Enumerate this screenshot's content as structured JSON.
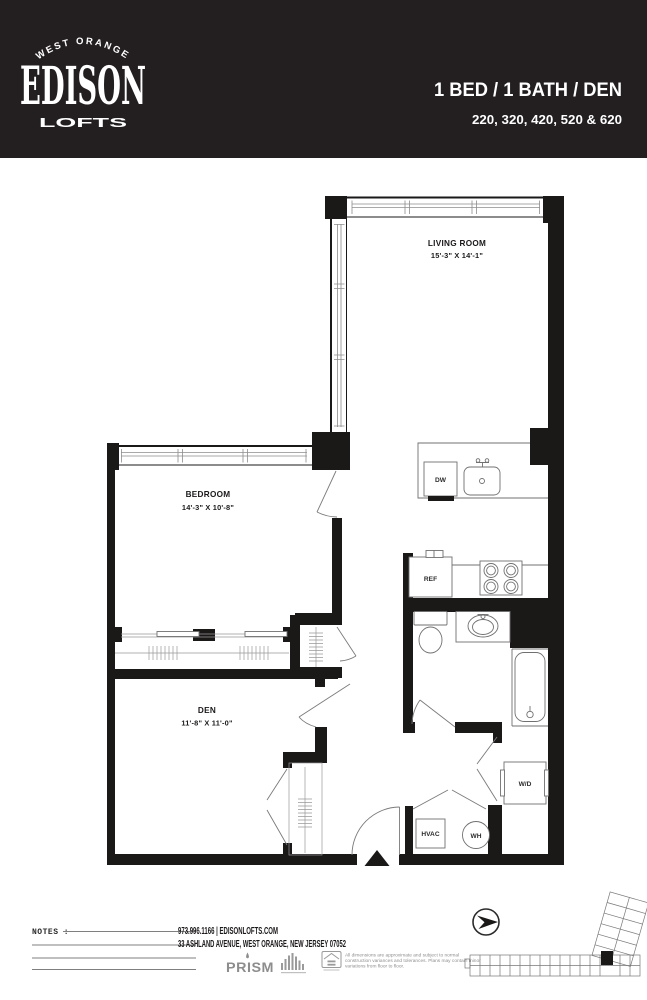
{
  "colors": {
    "header_bg": "#231f20",
    "walls": "#1b1818",
    "fixture_line": "#707070"
  },
  "header": {
    "brand_location": "WEST ORANGE",
    "brand_name": "EDISON",
    "brand_suffix": "LOFTS",
    "unit_type": "1 BED / 1 BATH / DEN",
    "unit_numbers": "220, 320, 420, 520 & 620"
  },
  "plan": {
    "living_room": {
      "name": "LIVING ROOM",
      "dims": "15'-3\" X 14'-1\""
    },
    "bedroom": {
      "name": "BEDROOM",
      "dims": "14'-3\" X 10'-8\""
    },
    "den": {
      "name": "DEN",
      "dims": "11'-8\" X 11'-0\""
    },
    "labels": {
      "dishwasher": "DW",
      "refrigerator": "REF",
      "washer_dryer": "W/D",
      "hvac": "HVAC",
      "water_heater": "WH"
    }
  },
  "footer": {
    "notes_label": "NOTES :",
    "contact": "973.996.1166 | EDISONLOFTS.COM",
    "address": "33 ASHLAND AVENUE, WEST ORANGE, NEW JERSEY 07052",
    "brand_logo": "PRISM",
    "disclaimer_line1": "All dimensions are approximate and subject to normal",
    "disclaimer_line2": "construction variances and tolerances. Plans may contain minor",
    "disclaimer_line3": "variations from floor to floor."
  }
}
